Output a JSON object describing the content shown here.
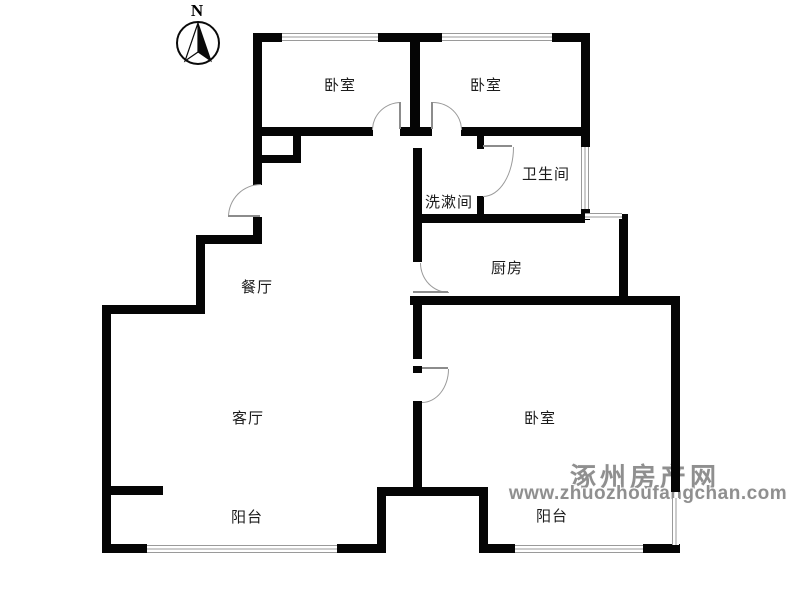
{
  "compass": {
    "north_label": "N"
  },
  "rooms": {
    "bedroom_a": "卧室",
    "bedroom_b": "卧室",
    "bathroom": "卫生间",
    "washroom": "洗漱间",
    "kitchen": "厨房",
    "dining": "餐厅",
    "living": "客厅",
    "bedroom_c": "卧室",
    "balcony_left": "阳台",
    "balcony_right": "阳台"
  },
  "watermark": {
    "site_name": "涿州房产网",
    "site_url": "www.zhuozhoufangchan.com"
  },
  "colors": {
    "wall": "#050505",
    "window_line": "#9a9a9a",
    "door_line": "#8c8c8c",
    "watermark_gray": "#8f8f8f",
    "background": "#ffffff"
  }
}
